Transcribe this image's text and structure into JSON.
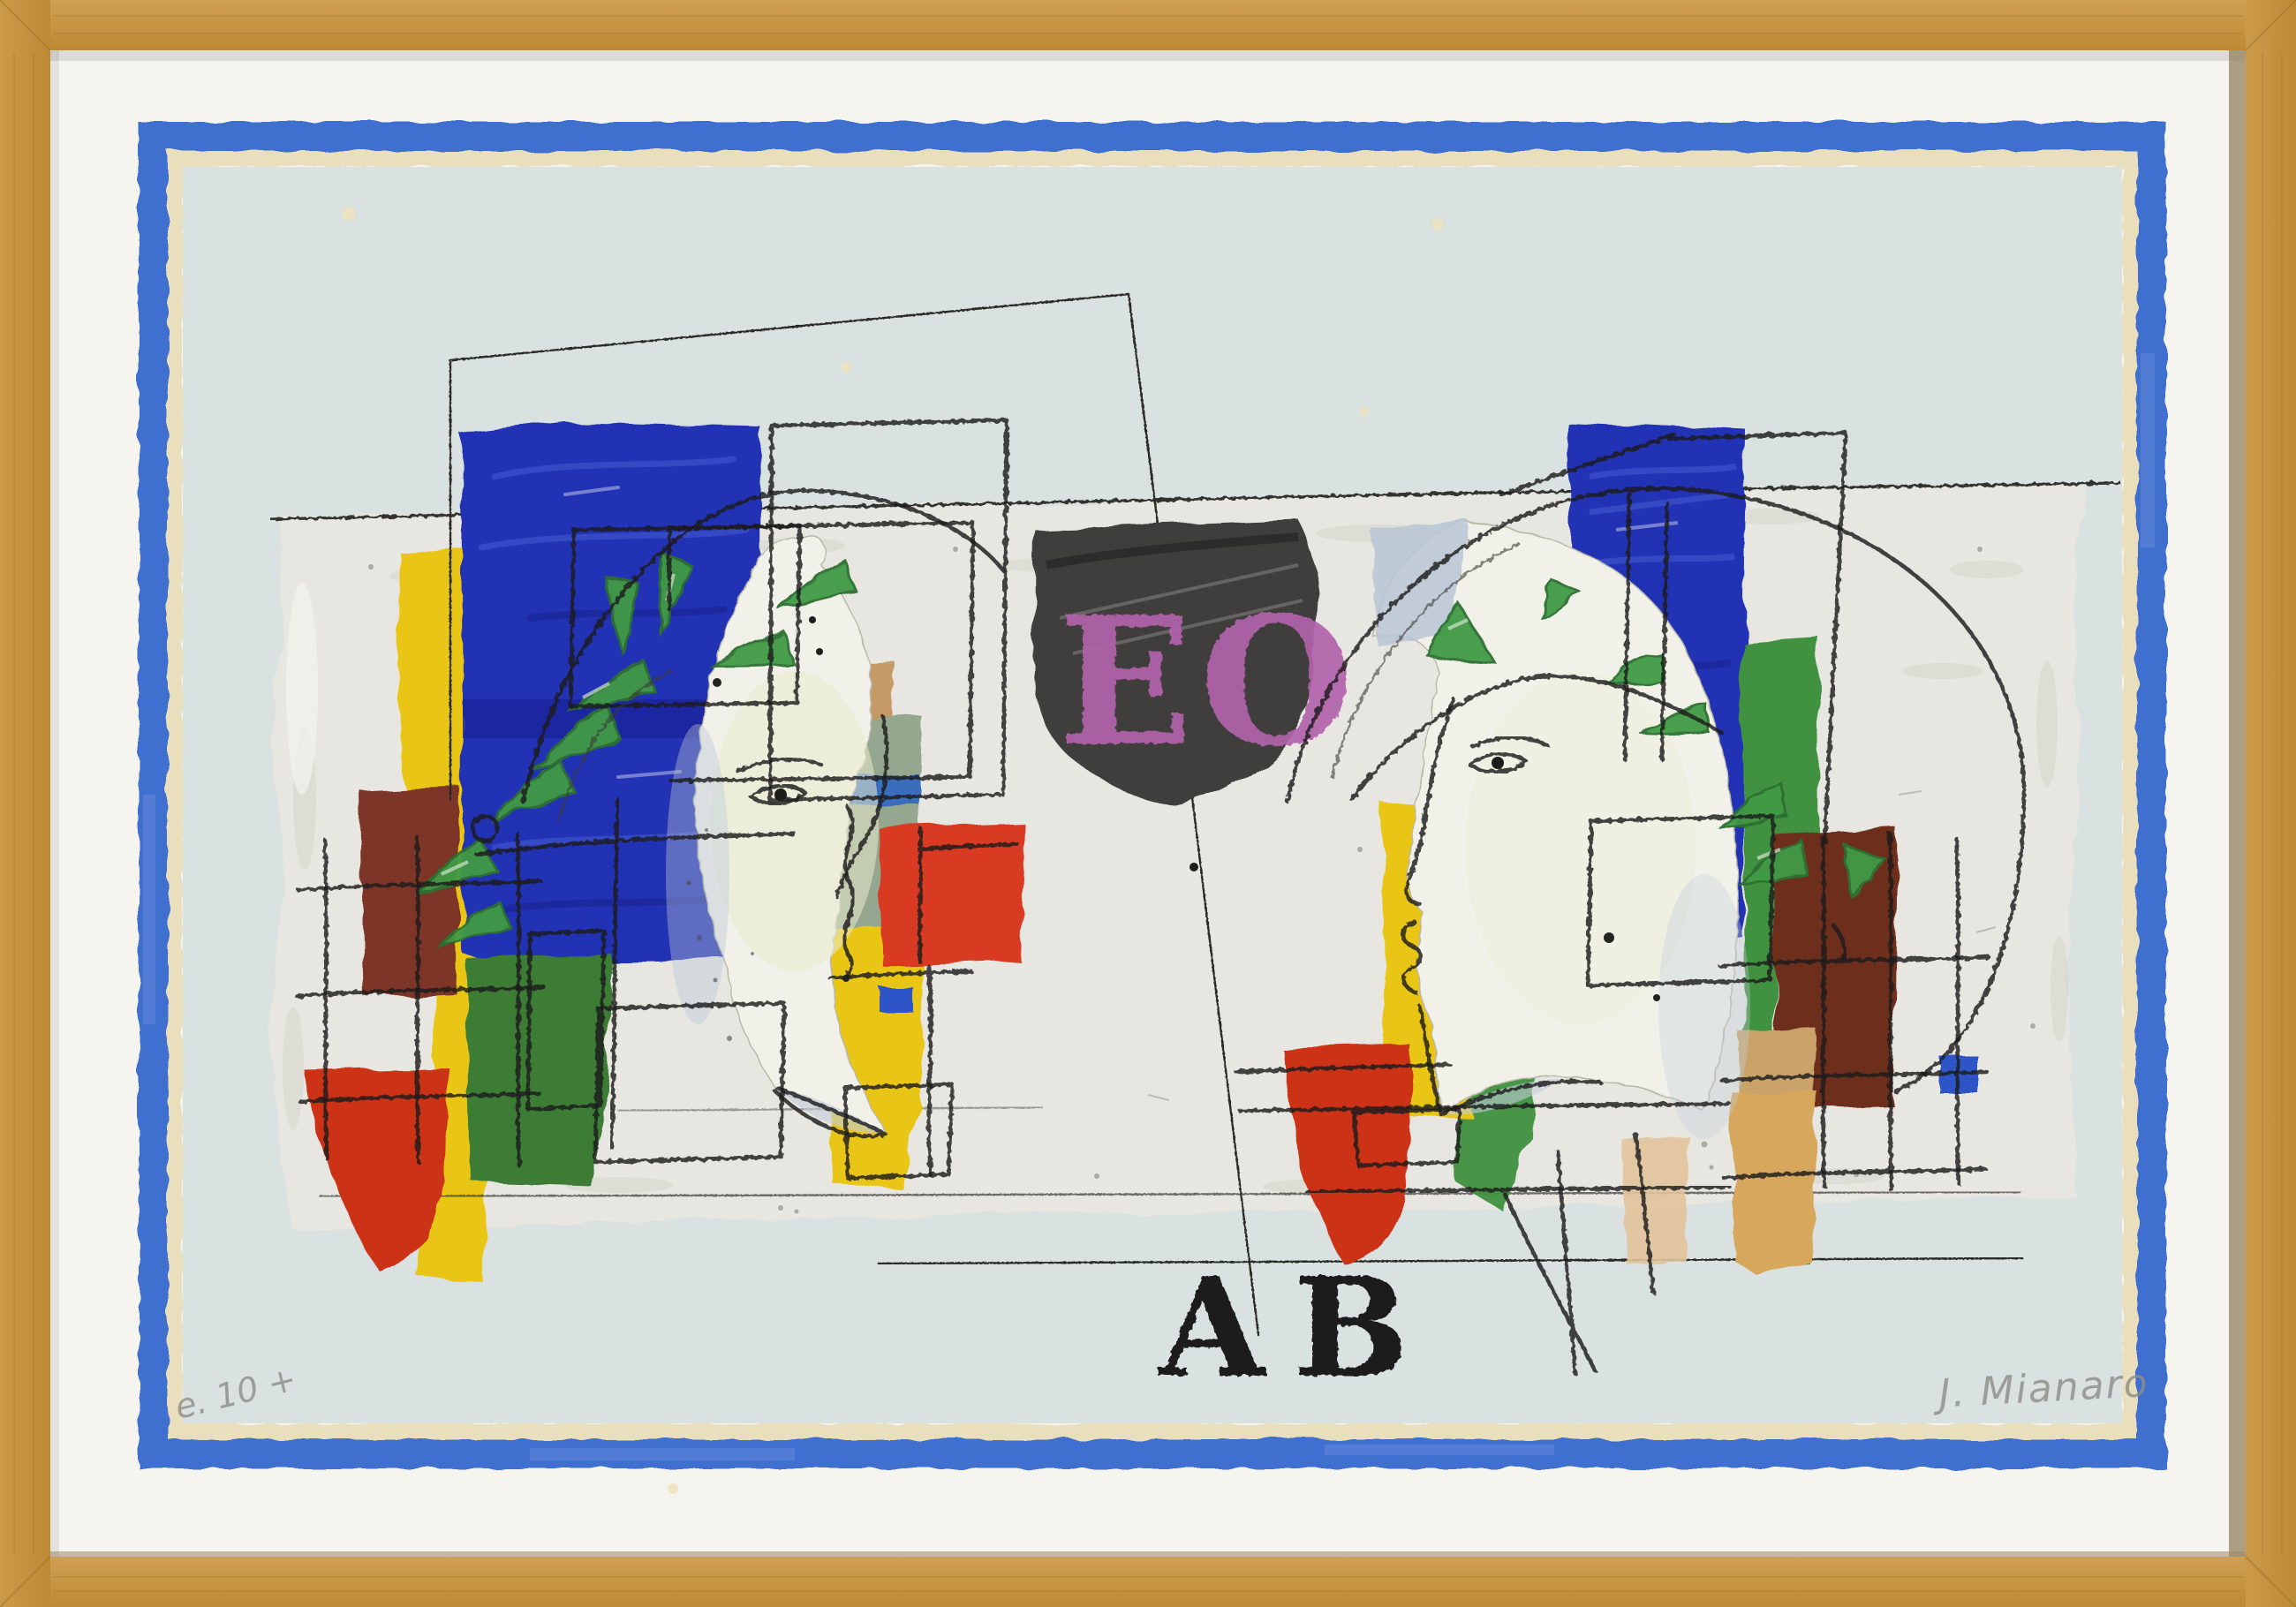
{
  "artwork": {
    "stencil_top": "EO",
    "stencil_bottom": "AB",
    "signature": "J. Mianaro",
    "edition_mark": "e. 10 +"
  },
  "palette": {
    "wood": "#c6953f",
    "wood_light": "#d3a558",
    "mat": "#f6f4ee",
    "border_blue": "#4070cf",
    "margin_cream": "#eadfbd",
    "paper": "#dae1e1",
    "band": "#e7e6e1",
    "ultramarine": "#2433b4",
    "ultramarine_dark": "#1b259c",
    "yellow": "#e9c613",
    "red": "#d83a20",
    "red_deep": "#cb3118",
    "green_dark": "#3c7c34",
    "green_mid": "#3f9140",
    "leaf_green": "#3f9b45",
    "sage": "#95a78e",
    "sage_blue": "#3a6dbd",
    "maroon_left": "#7b3426",
    "maroon_right": "#6e2e1c",
    "tan": "#c59a66",
    "peach": "#ecc9a2",
    "tan_mid": "#c9a36b",
    "ochre": "#d6a75c",
    "charcoal": "#3f3e3e",
    "stencil_purple": "#b263ac",
    "ink": "#1f1e1b",
    "pencil": "#8d8d88",
    "face_white": "#f2f1e9",
    "face_shadow": "#b9c6d6",
    "face_tint": "#e9ebce"
  }
}
